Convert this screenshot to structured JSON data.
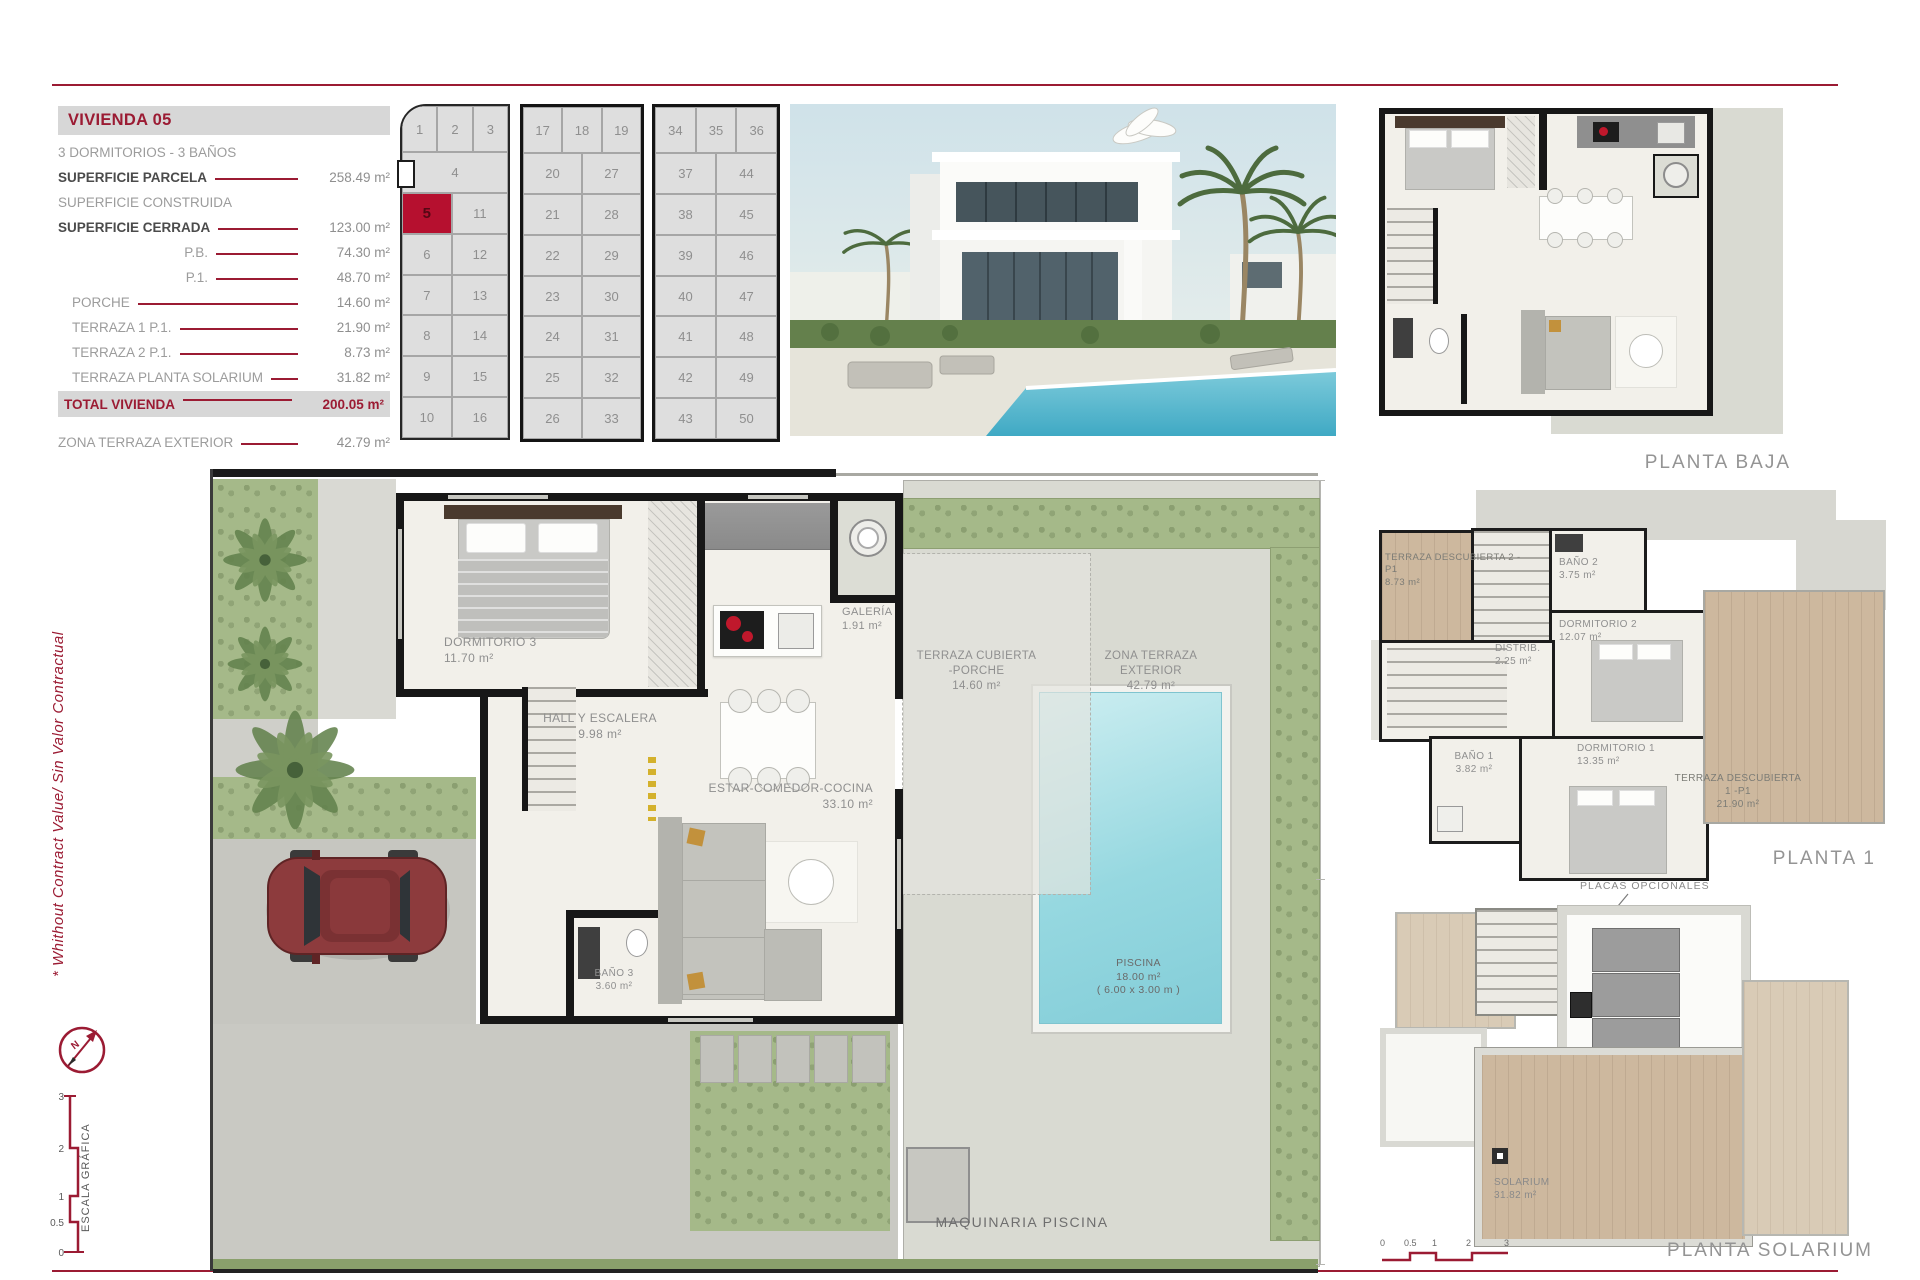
{
  "accent": "#9b1b33",
  "doc": {
    "info": {
      "title": "VIVIENDA 05",
      "rows": [
        {
          "label": "3 DORMITORIOS - 3 BAÑOS",
          "value": "",
          "cls": "muted"
        },
        {
          "label": "SUPERFICIE PARCELA",
          "value": "258.49 m²",
          "cls": "bold"
        },
        {
          "label": "SUPERFICIE CONSTRUIDA",
          "value": "",
          "cls": "muted"
        },
        {
          "label": "SUPERFICIE CERRADA",
          "value": "123.00 m²",
          "cls": "bold"
        },
        {
          "label": "P.B.",
          "value": "74.30 m²",
          "cls": "right"
        },
        {
          "label": "P.1.",
          "value": "48.70 m²",
          "cls": "right"
        },
        {
          "label": "PORCHE",
          "value": "14.60 m²",
          "cls": "pad"
        },
        {
          "label": "TERRAZA 1 P.1.",
          "value": "21.90 m²",
          "cls": "pad"
        },
        {
          "label": "TERRAZA 2 P.1.",
          "value": "8.73 m²",
          "cls": "pad"
        },
        {
          "label": "TERRAZA PLANTA SOLARIUM",
          "value": "31.82 m²",
          "cls": "pad"
        }
      ],
      "total": {
        "label": "TOTAL VIVIENDA",
        "value": "200.05 m²"
      },
      "extra": {
        "label": "ZONA TERRAZA EXTERIOR",
        "value": "42.79 m²"
      }
    },
    "site": {
      "highlight": "5",
      "blocks": [
        {
          "top": [
            "1",
            "2",
            "3"
          ],
          "rows": [
            [
              "",
              "4"
            ],
            [
              "5",
              "11"
            ],
            [
              "6",
              "12"
            ],
            [
              "7",
              "13"
            ],
            [
              "8",
              "14"
            ],
            [
              "9",
              "15"
            ],
            [
              "10",
              "16"
            ]
          ]
        },
        {
          "top": [
            "17",
            "18",
            "19"
          ],
          "rows": [
            [
              "20",
              "27"
            ],
            [
              "21",
              "28"
            ],
            [
              "22",
              "29"
            ],
            [
              "23",
              "30"
            ],
            [
              "24",
              "31"
            ],
            [
              "25",
              "32"
            ],
            [
              "26",
              "33"
            ]
          ]
        },
        {
          "top": [
            "34",
            "35",
            "36"
          ],
          "rows": [
            [
              "37",
              "44"
            ],
            [
              "38",
              "45"
            ],
            [
              "39",
              "46"
            ],
            [
              "40",
              "47"
            ],
            [
              "41",
              "48"
            ],
            [
              "42",
              "49"
            ],
            [
              "43",
              "50"
            ]
          ]
        }
      ]
    },
    "main": {
      "dorm3": {
        "name": "DORMITORIO 3",
        "area": "11.70 m²"
      },
      "hall": {
        "name": "HALL Y ESCALERA",
        "area": "9.98 m²"
      },
      "estar": {
        "name": "ESTAR-COMEDOR-COCINA",
        "area": "33.10 m²"
      },
      "galeria": {
        "name": "GALERÍA",
        "area": "1.91 m²"
      },
      "bano3": {
        "name": "BAÑO 3",
        "area": "3.60 m²"
      },
      "porche": {
        "name": "TERRAZA CUBIERTA -PORCHE",
        "area": "14.60 m²"
      },
      "zona": {
        "name": "ZONA TERRAZA EXTERIOR",
        "area": "42.79 m²"
      },
      "piscina": {
        "name": "PISCINA",
        "area": "18.00 m²",
        "dim": "( 6.00 x 3.00 m )"
      },
      "maquinaria": "MAQUINARIA PISCINA"
    },
    "pb": {
      "label": "PLANTA BAJA"
    },
    "p1": {
      "label": "PLANTA 1",
      "terraza2": {
        "name": "TERRAZA DESCUBIERTA 2 -P1",
        "area": "8.73 m²"
      },
      "bano2": {
        "name": "BAÑO 2",
        "area": "3.75 m²"
      },
      "dorm2": {
        "name": "DORMITORIO 2",
        "area": "12.07 m²"
      },
      "distrib": {
        "name": "DISTRIB.",
        "area": "2.25 m²"
      },
      "bano1": {
        "name": "BAÑO 1",
        "area": "3.82 m²"
      },
      "dorm1": {
        "name": "DORMITORIO 1",
        "area": "13.35 m²"
      },
      "terraza1": {
        "name": "TERRAZA DESCUBIERTA 1 -P1",
        "area": "21.90 m²"
      }
    },
    "sol": {
      "label": "PLANTA SOLARIUM",
      "note": "PLACAS OPCIONALES",
      "solarium": {
        "name": "SOLARIUM",
        "area": "31.82 m²"
      },
      "ticks": [
        "0",
        "0.5",
        "1",
        "2",
        "3"
      ]
    },
    "side_note": "* Whithout Contract Value/ Sin Valor Contractual",
    "escala": {
      "label": "ESCALA GRÁFICA",
      "ticks": [
        "0",
        "0.5",
        "1",
        "2",
        "3"
      ]
    },
    "compass_n": "N"
  }
}
